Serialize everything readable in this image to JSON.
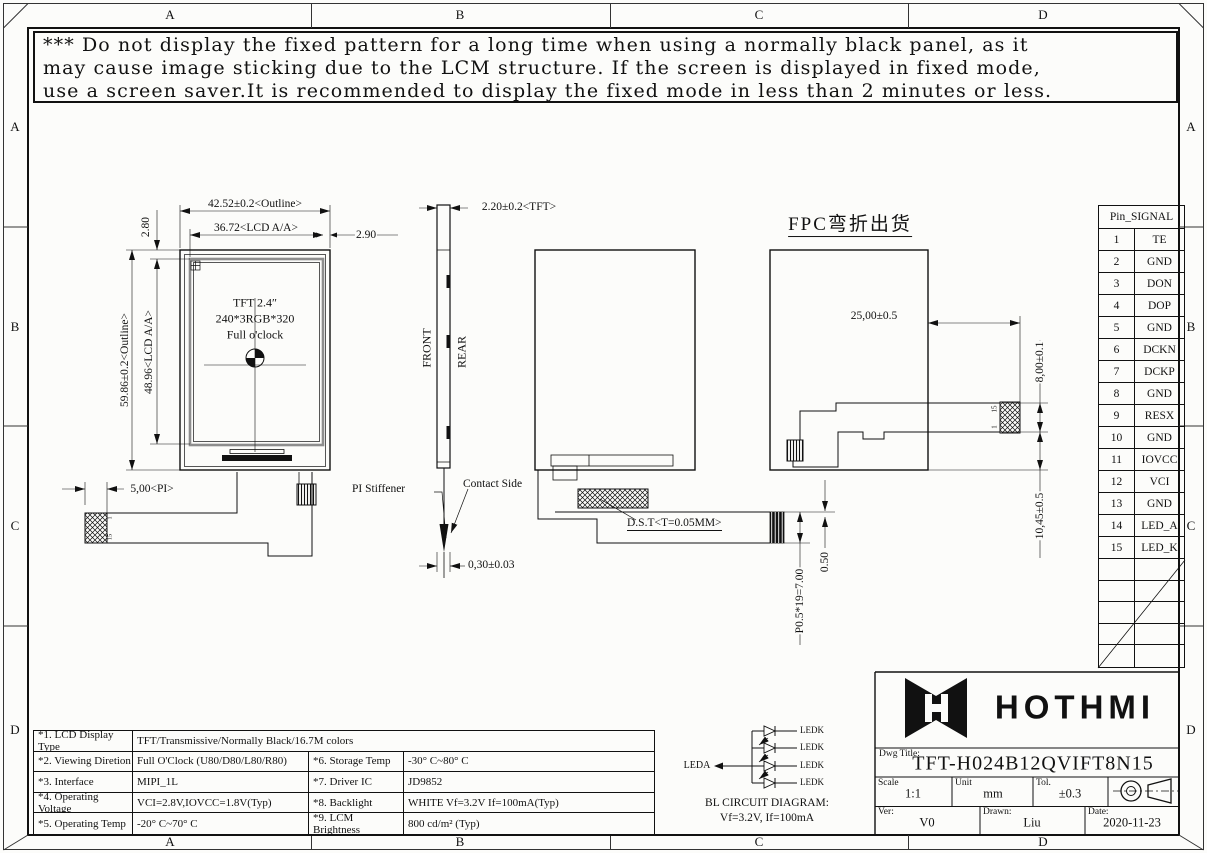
{
  "zones": {
    "cols": [
      "A",
      "B",
      "C",
      "D"
    ],
    "rows": [
      "A",
      "B",
      "C",
      "D"
    ]
  },
  "warning": {
    "lines": [
      "*** Do not display the fixed pattern for a long time when using a normally black panel, as it",
      "may cause image sticking due to the LCM structure. If the screen is displayed in fixed mode,",
      "use a screen saver.It is recommended to display the fixed mode in less than 2 minutes or less."
    ]
  },
  "front_view": {
    "title_lines": [
      "TFT 2.4″",
      "240*3RGB*320",
      "Full o'clock"
    ],
    "dims": {
      "outline_w": "42.52±0.2<Outline>",
      "aa_w": "36.72<LCD A/A>",
      "right_gap": "2.90",
      "top_gap": "2.80",
      "outline_h": "59.86±0.2<Outline>",
      "aa_h": "48.96<LCD A/A>",
      "pi": "5,00<PI>"
    },
    "pins": {
      "first": "1",
      "last": "15"
    }
  },
  "side_view": {
    "dims": {
      "tft": "2.20±0.2<TFT>",
      "tip": "0,30±0.03"
    },
    "labels": {
      "front": "FRONT",
      "rear": "REAR",
      "pi_stiffener": "PI Stiffener",
      "contact_side": "Contact Side"
    }
  },
  "rear_view": {
    "labels": {
      "dst": "D.S.T<T=0.05MM>"
    },
    "dims": {
      "pitch": "P0.5*19=7.00",
      "offset": "0.50"
    }
  },
  "bent_view": {
    "title": "FPC弯折出货",
    "dims": {
      "w": "25,00±0.5",
      "fold": "8,00±0.1",
      "h": "10,45±0.5"
    },
    "pins": {
      "last": "15",
      "first": "1"
    }
  },
  "pin_table": {
    "header": "Pin_SIGNAL",
    "rows": [
      {
        "pin": "1",
        "signal": "TE"
      },
      {
        "pin": "2",
        "signal": "GND"
      },
      {
        "pin": "3",
        "signal": "DON"
      },
      {
        "pin": "4",
        "signal": "DOP"
      },
      {
        "pin": "5",
        "signal": "GND"
      },
      {
        "pin": "6",
        "signal": "DCKN"
      },
      {
        "pin": "7",
        "signal": "DCKP"
      },
      {
        "pin": "8",
        "signal": "GND"
      },
      {
        "pin": "9",
        "signal": "RESX"
      },
      {
        "pin": "10",
        "signal": "GND"
      },
      {
        "pin": "11",
        "signal": "IOVCC"
      },
      {
        "pin": "12",
        "signal": "VCI"
      },
      {
        "pin": "13",
        "signal": "GND"
      },
      {
        "pin": "14",
        "signal": "LED_A"
      },
      {
        "pin": "15",
        "signal": "LED_K"
      }
    ]
  },
  "spec_table": {
    "rows": [
      {
        "no": "*1. LCD Display Type",
        "val": "TFT/Transmissive/Normally Black/16.7M colors",
        "no2": "",
        "val2": ""
      },
      {
        "no": "*2. Viewing Diretion",
        "val": "Full O'Clock (U80/D80/L80/R80)",
        "no2": "*6. Storage Temp",
        "val2": "-30° C~80° C"
      },
      {
        "no": "*3. Interface",
        "val": "MIPI_1L",
        "no2": "*7. Driver IC",
        "val2": "JD9852"
      },
      {
        "no": "*4. Operating Voltage",
        "val": "VCI=2.8V,IOVCC=1.8V(Typ)",
        "no2": "*8. Backlight",
        "val2": "WHITE Vf=3.2V If=100mA(Typ)"
      },
      {
        "no": "*5. Operating Temp",
        "val": "-20° C~70° C",
        "no2": "*9. LCM Brightness",
        "val2": "800 cd/m² (Typ)"
      }
    ]
  },
  "bl_circuit": {
    "anode": "LEDA",
    "ledk_labels": [
      "LEDK",
      "LEDK",
      "LEDK",
      "LEDK"
    ],
    "caption": [
      "BL CIRCUIT DIAGRAM:",
      "Vf=3.2V, If=100mA"
    ]
  },
  "title_block": {
    "brand": "HOTHMI",
    "dwg_title_label": "Dwg Title:",
    "dwg_title": "TFT-H024B12QVIFT8N15",
    "scale_label": "Scale",
    "scale": "1:1",
    "unit_label": "Unit",
    "unit": "mm",
    "tol_label": "Tol.",
    "tol": "±0.3",
    "ver_label": "Ver:",
    "ver": "V0",
    "drawn_label": "Drawn:",
    "drawn": "Liu",
    "date_label": "Date:",
    "date": "2020-11-23"
  }
}
